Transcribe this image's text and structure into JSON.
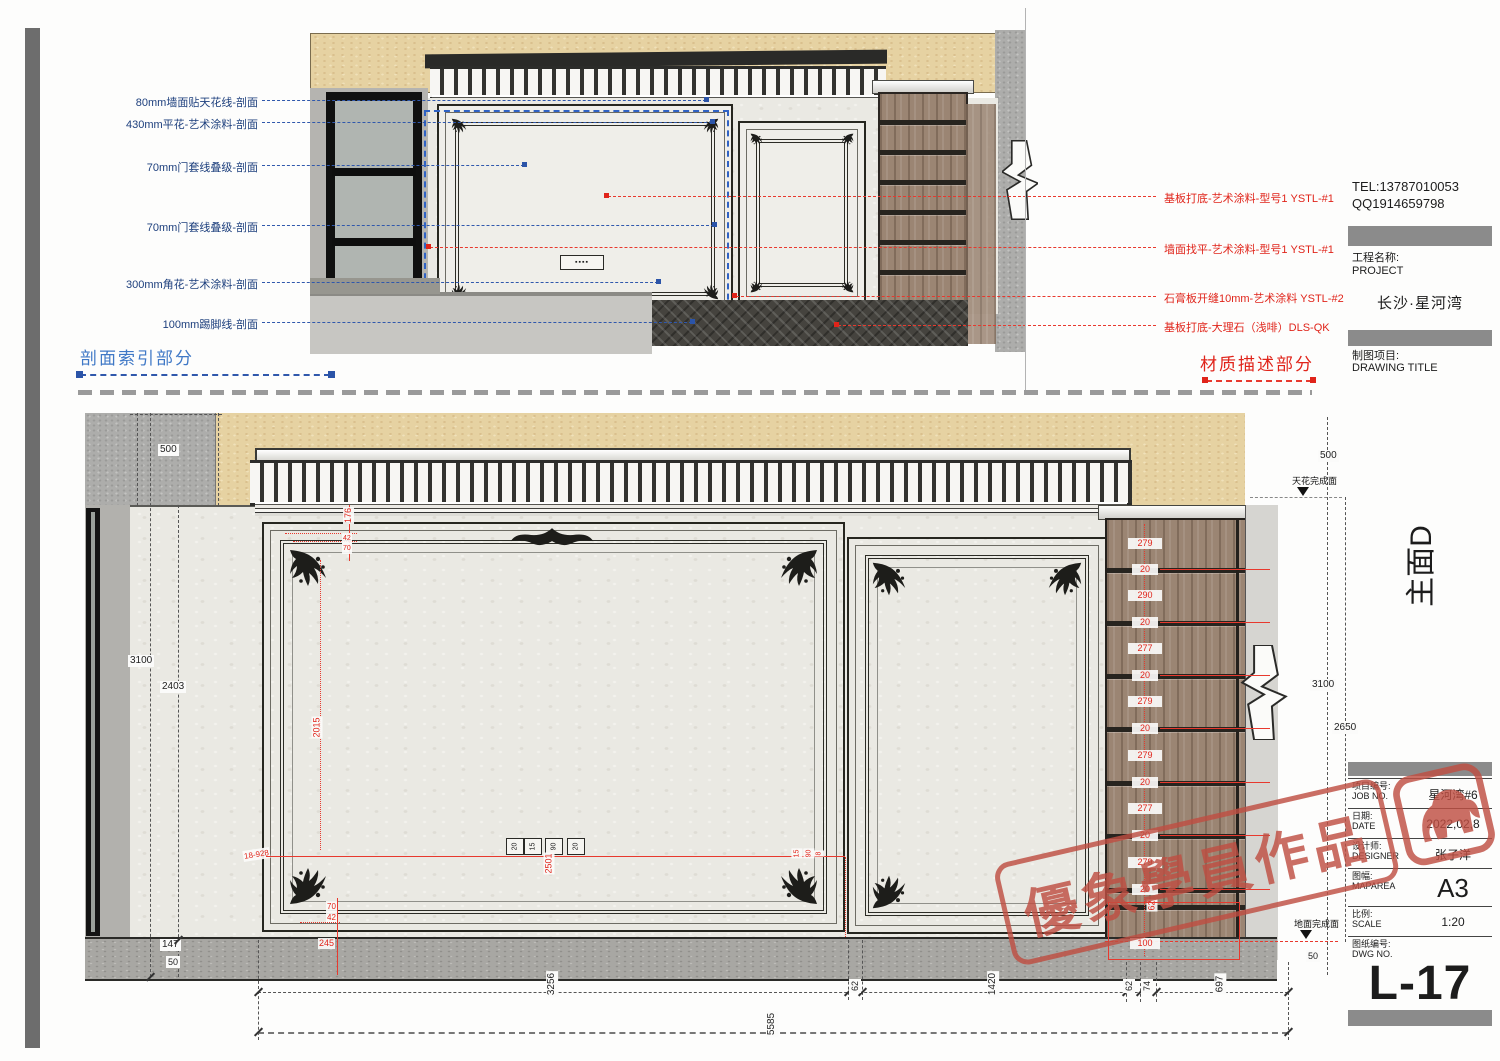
{
  "section": {
    "caption_left": "剖面索引部分",
    "caption_right": "材质描述部分",
    "tiny_label": "▪▪▪▪",
    "callouts_left": [
      "80mm墙面贴天花线-剖面",
      "430mm平花-艺术涂料-剖面",
      "70mm门套线叠级-剖面",
      "70mm门套线叠级-剖面",
      "300mm角花-艺术涂料-剖面",
      "100mm踢脚线-剖面"
    ],
    "callouts_right": [
      "基板打底-艺术涂料-型号1 YSTL-#1",
      "墙面找平-艺术涂料-型号1 YSTL-#1",
      "石膏板开缝10mm-艺术涂料 YSTL-#2",
      "基板打底-大理石（浅啡）DLS-QK"
    ]
  },
  "titleblock": {
    "tel": "TEL:13787010053",
    "qq": "QQ1914659798",
    "project_label_cn": "工程名称:",
    "project_label_en": "PROJECT",
    "project_name": "长沙·星河湾",
    "drawing_label_cn": "制图项目:",
    "drawing_label_en": "DRAWING TITLE",
    "elevation_name": "主面D",
    "rows": [
      {
        "cn": "项目编号:",
        "en": "JOB NO.",
        "value": "星河湾#6"
      },
      {
        "cn": "日期:",
        "en": "DATE",
        "value": "2022,02,8"
      },
      {
        "cn": "设计师:",
        "en": "DESIGNER",
        "value": "张子洋"
      },
      {
        "cn": "图幅:",
        "en": "MAPAREA",
        "value": "A3"
      },
      {
        "cn": "比例:",
        "en": "SCALE",
        "value": "1:20"
      },
      {
        "cn": "图纸编号:",
        "en": "DWG NO.",
        "value": ""
      }
    ],
    "dwg_no": "L-17"
  },
  "elevation": {
    "levels": {
      "ceiling": "天花完成面",
      "floor": "地面完成面"
    },
    "dims_left": {
      "top": "500",
      "overall": "3100",
      "panel": "2403",
      "base": "147",
      "toe": "50"
    },
    "dims_right": {
      "top": "500",
      "overall": "3100",
      "clear": "2650",
      "toe": "50"
    },
    "dims_bottom": {
      "segments": [
        "3256",
        "62",
        "1420",
        "62",
        "74",
        "697"
      ],
      "total": "5585"
    },
    "cabinet_dims": [
      "279",
      "20",
      "290",
      "20",
      "277",
      "20",
      "279",
      "20",
      "279",
      "20",
      "277",
      "20",
      "279",
      "20"
    ],
    "cabinet_dim_side": "62",
    "cabinet_dim_base": "100",
    "red": {
      "a": "176",
      "b": "42",
      "c": "70",
      "v": "2015",
      "note": "18-928",
      "d": "70",
      "e": "42",
      "f": "245",
      "center": "2501",
      "g1": "20",
      "g2": "15",
      "g3": "90",
      "g4": "20",
      "h1": "15",
      "h2": "90",
      "h3": "8"
    }
  },
  "watermark": {
    "text": "優象學員作品"
  }
}
